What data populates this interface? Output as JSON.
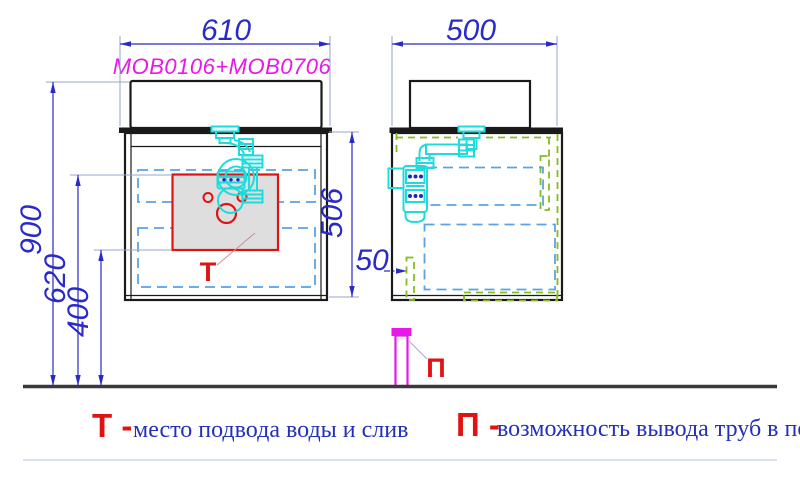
{
  "drawing": {
    "model_label": "MOB0106+MOB0706",
    "dimensions": {
      "front_width": "610",
      "side_depth": "500",
      "height_total": "900",
      "height_t_zone_top": "620",
      "height_t_zone_bottom": "400",
      "cabinet_height": "506",
      "floor_gap": "50"
    },
    "markers": {
      "t_water_point": "Т",
      "p_floor_pipe": "П"
    },
    "colors": {
      "dimension_blue": "#2a2ac8",
      "drawer_dash_blue": "#57a3e8",
      "clearance_green": "#85bc22",
      "plumbing_cyan": "#1fdbdb",
      "fitting_dot_blue": "#2026c0",
      "accent_red": "#e01212",
      "accent_magenta": "#e619e6",
      "zone_fill_grey": "#dedede",
      "floor_dark": "#3a3a3a"
    }
  },
  "legend": {
    "t_marker": "Т -",
    "t_text": "место подвода воды и слив",
    "p_marker": "П -",
    "p_text": "возможность вывода труб в пол"
  }
}
